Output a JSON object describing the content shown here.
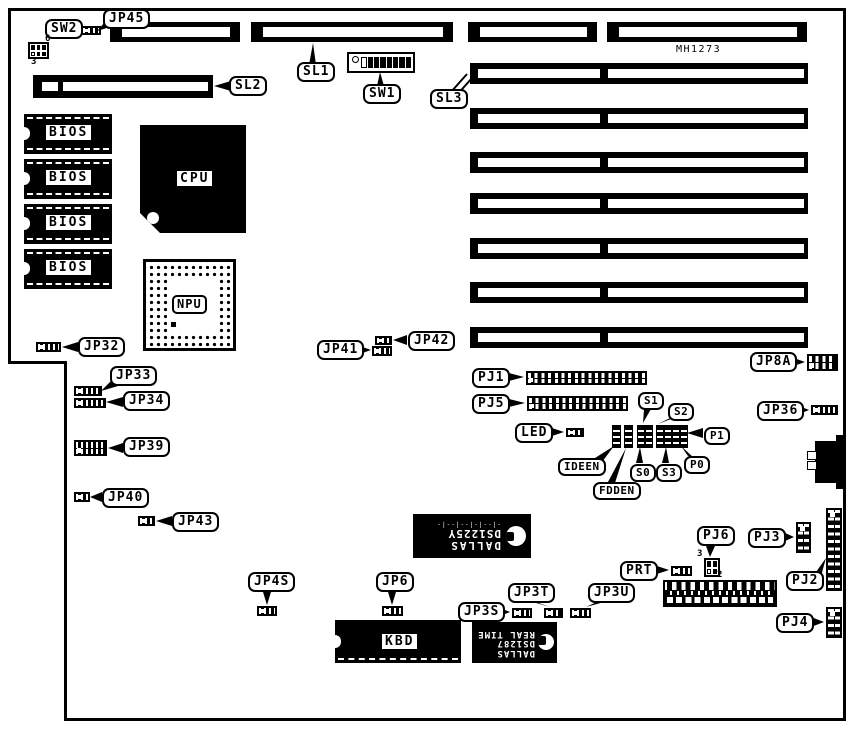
{
  "board": {
    "model": "MH1273"
  },
  "colors": {
    "ink": "#000000",
    "paper": "#ffffff"
  },
  "callouts": {
    "sw2": "SW2",
    "jp45": "JP45",
    "sl1": "SL1",
    "sw1": "SW1",
    "sl2": "SL2",
    "sl3": "SL3",
    "jp32": "JP32",
    "jp33": "JP33",
    "jp34": "JP34",
    "jp39": "JP39",
    "jp40": "JP40",
    "jp43": "JP43",
    "jp41": "JP41",
    "jp42": "JP42",
    "pj1": "PJ1",
    "pj5": "PJ5",
    "led": "LED",
    "s1": "S1",
    "s2": "S2",
    "p1": "P1",
    "p0": "P0",
    "s0": "S0",
    "s3": "S3",
    "ideen": "IDEEN",
    "fdden": "FDDEN",
    "jp8a": "JP8A",
    "jp36": "JP36",
    "prt": "PRT",
    "pj6": "PJ6",
    "pj3": "PJ3",
    "pj2": "PJ2",
    "pj4": "PJ4",
    "jp4s": "JP4S",
    "jp6": "JP6",
    "jp3s": "JP3S",
    "jp3t": "JP3T",
    "jp3u": "JP3U"
  },
  "chips": {
    "bios": "BIOS",
    "cpu": "CPU",
    "npu": "NPU",
    "kbd": "KBD"
  },
  "dallas_nvram": {
    "brand": "DALLAS",
    "part": "DS1225Y",
    "datecode": "-|--|-|--|--|-"
  },
  "dallas_rtc": {
    "brand": "DALLAS",
    "part": "DS1287",
    "function": "REAL TIME"
  },
  "pin_numbers": {
    "sw2_top": "6",
    "sw2_bottom": "3",
    "pj6_top": "3",
    "pj6_bottom": "2"
  }
}
